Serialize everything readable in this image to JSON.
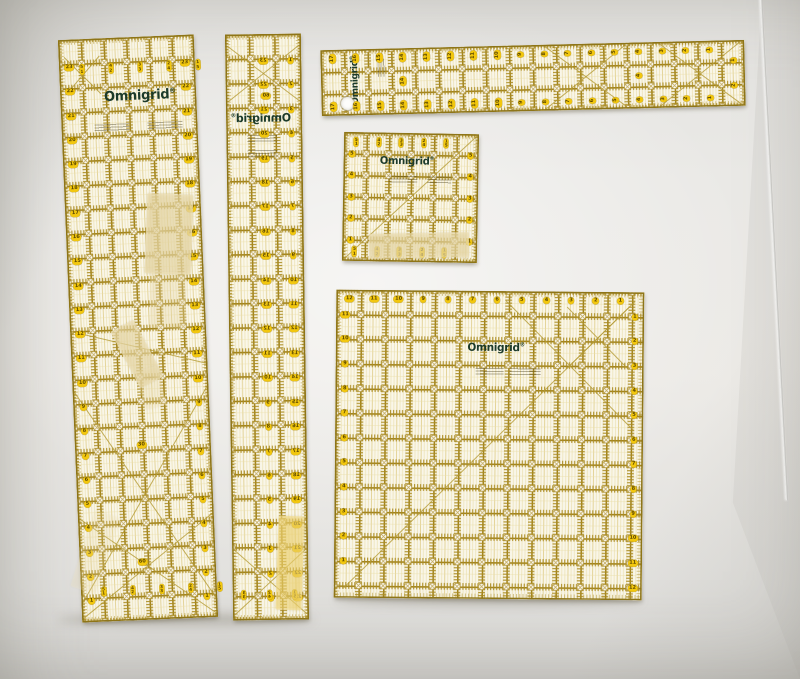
{
  "scene": {
    "description": "Five transparent yellow-grid Omnigrid quilting rulers on a white surface",
    "wall_color": "#eceae6",
    "seam": {
      "x1": 760,
      "y1": -6,
      "x2": 734,
      "y2": 500
    }
  },
  "palette": {
    "body": "#faf6e9",
    "grid": "#a1831c",
    "grid_dark": "#8e7518",
    "tick": "#ab8c22",
    "pale": "#e9dca6",
    "pale_mid": "#dcc87e",
    "circle_fill": "#fcfaf3",
    "circle_stroke": "#b49a45",
    "pill_bg": "#f2c70e",
    "pill_text": "#5a4600",
    "logo_green": "#1c3a2a",
    "tape": "#e2d2a0",
    "tape_yellow": "#e9cd6a"
  },
  "brand": {
    "logo_text": "Omnigrid",
    "registered": "®"
  },
  "rulers": [
    {
      "name": "ruler-6x24-left",
      "x": 70,
      "y": 37,
      "w": 136,
      "h": 583,
      "rot": -2.4,
      "cols": 6,
      "rows": 24,
      "logo": {
        "x": 0.585,
        "y": 0.101,
        "fs": 13,
        "rot": 0
      },
      "fineprint": [
        {
          "x": 0.24,
          "y": 0.148,
          "w": 0.26
        },
        {
          "x": 0.63,
          "y": 0.148,
          "w": 0.26
        }
      ],
      "sets": [
        {
          "kind": "col",
          "x": 0.925,
          "row0": 1.15,
          "vals": [
            23,
            22,
            21,
            20,
            19,
            18,
            17,
            16,
            15,
            14,
            13,
            12,
            11,
            10,
            9,
            8,
            7,
            6,
            5,
            4,
            3,
            2,
            1
          ]
        },
        {
          "kind": "col",
          "x": 0.075,
          "row0": 1.15,
          "vals": [
            23,
            22,
            21,
            20,
            19,
            18,
            17,
            16,
            15,
            14,
            13,
            12,
            11,
            10,
            9,
            8,
            7,
            6,
            5,
            4,
            3,
            2,
            1
          ]
        },
        {
          "kind": "row",
          "y": 0.052,
          "col0": 1.0,
          "stepc": 1.28,
          "vals": [
            "5\n1",
            "4\n2",
            "3\n3",
            "2\n4",
            "1\n5"
          ]
        },
        {
          "kind": "row",
          "y": 0.948,
          "col0": 1.0,
          "stepc": 1.28,
          "vals": [
            "5\n1",
            "4\n2",
            "3\n3",
            "2\n4",
            "1\n5"
          ]
        },
        {
          "kind": "abs",
          "items": [
            {
              "t": "30",
              "x": 0.49,
              "y": 0.7
            },
            {
              "t": "60",
              "x": 0.46,
              "y": 0.9
            }
          ]
        }
      ],
      "diag": [
        [
          0,
          0.5,
          1,
          0.565
        ],
        [
          0,
          0.97,
          1,
          0.6
        ],
        [
          0,
          0.6,
          1,
          0.97
        ],
        [
          0,
          0.995,
          1,
          0.82
        ],
        [
          0,
          0.82,
          1,
          0.995
        ],
        [
          0.04,
          0.03,
          0.3,
          0.095
        ],
        [
          0.3,
          0.03,
          0.04,
          0.095
        ]
      ]
    },
    {
      "name": "ruler-3x24-narrow",
      "x": 229,
      "y": 34,
      "w": 76,
      "h": 586,
      "rot": -0.8,
      "cols": 3,
      "rows": 24,
      "mirrored": true,
      "logo": {
        "x": 0.54,
        "y": 0.143,
        "fs": 11,
        "rot": 0
      },
      "fineprint": [
        {
          "x": 0.33,
          "y": 0.172,
          "w": 0.4
        },
        {
          "x": 0.33,
          "y": 0.198,
          "w": 0.4
        }
      ],
      "sets": [
        {
          "kind": "col",
          "x": 0.14,
          "row0": 1.1,
          "vals": [
            1,
            2,
            3,
            4,
            5,
            6,
            7,
            8,
            9,
            10,
            11,
            12,
            13,
            14,
            15,
            16,
            17,
            18,
            19,
            20,
            21,
            22,
            23
          ]
        },
        {
          "kind": "col",
          "x": 0.5,
          "row0": 1.1,
          "vals": [
            23,
            22,
            21,
            20,
            19,
            18,
            17,
            16,
            15,
            14,
            13,
            12,
            11,
            10,
            9,
            8,
            7,
            6,
            5,
            4,
            3,
            2,
            1
          ]
        },
        {
          "kind": "row",
          "y": 0.957,
          "col0": 0.55,
          "stepc": 1.0,
          "vals": [
            "1\n5",
            "2\n4",
            "3\n3"
          ]
        },
        {
          "kind": "abs",
          "items": [
            {
              "t": "60",
              "x": 0.47,
              "y": 0.105
            }
          ]
        }
      ],
      "diag": [
        [
          0.03,
          0.02,
          0.97,
          0.115
        ],
        [
          0.97,
          0.02,
          0.03,
          0.115
        ],
        [
          0.03,
          0.88,
          0.97,
          0.99
        ],
        [
          0.97,
          0.88,
          0.03,
          0.99
        ]
      ]
    },
    {
      "name": "ruler-3x18-horizontal",
      "x": 321,
      "y": 45,
      "w": 424,
      "h": 66,
      "rot": -1.4,
      "cols": 18,
      "rows": 3,
      "logo": {
        "x": 0.082,
        "y": 0.47,
        "fs": 9,
        "rot": -90
      },
      "hole": {
        "x": 0.062,
        "y": 0.82
      },
      "fineprint": [
        {
          "x": 0.135,
          "y": 0.42,
          "w": 0.042,
          "rot": -90
        }
      ],
      "sets": [
        {
          "kind": "row",
          "y": 0.13,
          "col0": 0.5,
          "stepc": 1,
          "rot": -90,
          "vals": [
            17,
            16,
            15,
            14,
            13,
            12,
            11,
            10,
            9,
            8,
            7,
            6,
            5,
            4,
            3,
            2,
            1
          ]
        },
        {
          "kind": "row",
          "y": 0.87,
          "col0": 0.5,
          "stepc": 1,
          "rot": -90,
          "vals": [
            17,
            16,
            15,
            14,
            13,
            12,
            11,
            10,
            9,
            8,
            7,
            6,
            5,
            4,
            3,
            2,
            1
          ]
        },
        {
          "kind": "abs",
          "items": [
            {
              "t": "14",
              "x": 0.194,
              "y": 0.5,
              "rot": -90
            },
            {
              "t": "4",
              "x": 0.75,
              "y": 0.5,
              "rot": -90
            },
            {
              "t": "1",
              "x": 0.975,
              "y": 0.3,
              "rot": -90
            },
            {
              "t": "2",
              "x": 0.975,
              "y": 0.68,
              "rot": -90
            }
          ]
        }
      ],
      "diag": [
        [
          0.53,
          0.03,
          0.72,
          0.97
        ],
        [
          0.72,
          0.03,
          0.53,
          0.97
        ],
        [
          0.8,
          0.03,
          0.99,
          0.97
        ],
        [
          0.99,
          0.03,
          0.8,
          0.97
        ]
      ]
    },
    {
      "name": "ruler-6x6-square",
      "x": 343,
      "y": 133,
      "w": 135,
      "h": 129,
      "rot": 1,
      "cols": 6,
      "rows": 6,
      "logo": {
        "x": 0.47,
        "y": 0.225,
        "fs": 10,
        "rot": 0
      },
      "fineprint": [
        {
          "x": 0.33,
          "y": 0.33,
          "w": 0.22
        },
        {
          "x": 0.62,
          "y": 0.33,
          "w": 0.18
        }
      ],
      "sets": [
        {
          "kind": "row",
          "y": 0.075,
          "col0": 0.55,
          "stepc": 1,
          "vals": [
            "5\n1",
            "4\n2",
            "3\n3",
            "2\n4",
            "1\n5"
          ]
        },
        {
          "kind": "row",
          "y": 0.925,
          "col0": 0.55,
          "stepc": 1,
          "vals": [
            "5\n1",
            "4\n2",
            "3\n3",
            "2\n4",
            "1\n5"
          ]
        },
        {
          "kind": "col",
          "x": 0.06,
          "row0": 1,
          "vals": [
            5,
            4,
            3,
            2,
            1
          ]
        },
        {
          "kind": "col",
          "x": 0.94,
          "row0": 1,
          "vals": [
            5,
            4,
            3,
            2,
            1
          ]
        }
      ],
      "diag": [
        [
          0.02,
          0.98,
          0.98,
          0.02
        ]
      ]
    },
    {
      "name": "ruler-12x12-square",
      "x": 335,
      "y": 291,
      "w": 308,
      "h": 308,
      "rot": 0.5,
      "cols": 12.5,
      "rows": 12.5,
      "logo": {
        "x": 0.52,
        "y": 0.185,
        "fs": 10.5,
        "rot": 0
      },
      "fineprint": [
        {
          "x": 0.455,
          "y": 0.25,
          "w": 0.09
        },
        {
          "x": 0.565,
          "y": 0.25,
          "w": 0.1
        }
      ],
      "sets": [
        {
          "kind": "row",
          "y": 0.03,
          "col0": 0.53,
          "stepc": 1,
          "vals": [
            12,
            11,
            10,
            9,
            8,
            7,
            6,
            5,
            4,
            3,
            2,
            1
          ]
        },
        {
          "kind": "col",
          "x": 0.97,
          "row0": 1,
          "vals": [
            1,
            2,
            3,
            4,
            5,
            6,
            7,
            8,
            9,
            10,
            11,
            12
          ]
        },
        {
          "kind": "col",
          "x": 0.03,
          "row0": 1,
          "vals": [
            11,
            10,
            9,
            8,
            7,
            6,
            5,
            4,
            3,
            2,
            1
          ]
        }
      ],
      "diag": [
        [
          0.03,
          0.97,
          0.97,
          0.03
        ],
        [
          0.55,
          0.03,
          0.97,
          0.45
        ],
        [
          0.75,
          0.05,
          0.95,
          0.25
        ],
        [
          0.95,
          0.05,
          0.75,
          0.25
        ]
      ]
    }
  ],
  "tapes": [
    {
      "x": 146,
      "y": 194,
      "w": 46,
      "h": 80,
      "rot": 2,
      "o": 0.85,
      "c": "tape"
    },
    {
      "x": 150,
      "y": 272,
      "w": 36,
      "h": 56,
      "rot": 1,
      "o": 0.4,
      "c": "tape"
    },
    {
      "x": 124,
      "y": 322,
      "w": 26,
      "h": 64,
      "rot": -28,
      "o": 0.8,
      "c": "tape"
    },
    {
      "x": 140,
      "y": 368,
      "w": 22,
      "h": 40,
      "rot": -15,
      "o": 0.35,
      "c": "tape"
    },
    {
      "x": 369,
      "y": 233,
      "w": 100,
      "h": 25,
      "rot": -1,
      "o": 0.8,
      "c": "tape"
    },
    {
      "x": 277,
      "y": 516,
      "w": 26,
      "h": 94,
      "rot": 2,
      "o": 0.75,
      "c": "tape_yellow"
    },
    {
      "x": 82,
      "y": 512,
      "w": 26,
      "h": 80,
      "rot": 18,
      "o": 0.25,
      "c": "tape"
    }
  ]
}
